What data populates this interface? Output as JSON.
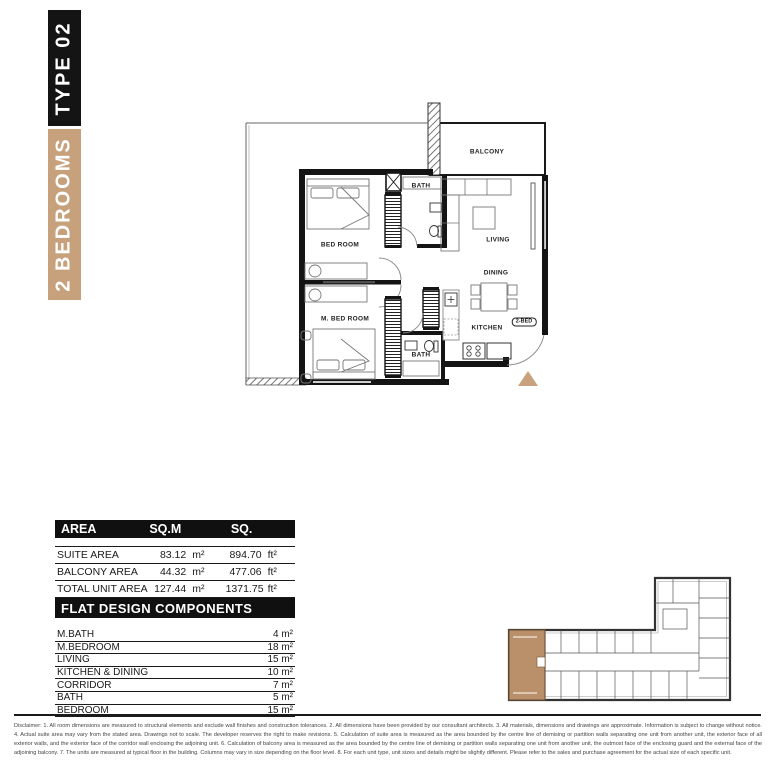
{
  "banner": {
    "type_label": "TYPE 02",
    "bedrooms_label": "2 BEDROOMS",
    "colors": {
      "type_bg": "#141414",
      "bedrooms_bg": "#c7a17c"
    }
  },
  "floor_plan": {
    "rooms": {
      "balcony": "BALCONY",
      "bedroom": "BED ROOM",
      "bath_top": "BATH",
      "living": "LIVING",
      "dining": "DINING",
      "kitchen": "KITCHEN",
      "master_bedroom": "M. BED ROOM",
      "bath_bottom": "BATH"
    },
    "unit_tag": "2-BED",
    "entry_marker_color": "#c8a27d"
  },
  "area_table": {
    "headers": [
      "AREA",
      "SQ.M",
      "SQ."
    ],
    "rows": [
      {
        "label": "SUITE AREA",
        "sqm": "83.12",
        "sqm_unit": "m²",
        "sqft": "894.70",
        "sqft_unit": "ft²"
      },
      {
        "label": "BALCONY AREA",
        "sqm": "44.32",
        "sqm_unit": "m²",
        "sqft": "477.06",
        "sqft_unit": "ft²"
      },
      {
        "label": "TOTAL UNIT AREA",
        "sqm": "127.44",
        "sqm_unit": "m²",
        "sqft": "1371.75",
        "sqft_unit": "ft²"
      }
    ]
  },
  "components_table": {
    "title": "FLAT DESIGN COMPONENTS",
    "rows": [
      {
        "label": "M.BATH",
        "value": "4 m²"
      },
      {
        "label": "M.BEDROOM",
        "value": "18 m²"
      },
      {
        "label": "LIVING",
        "value": "15 m²"
      },
      {
        "label": "KITCHEN & DINING",
        "value": "10 m²"
      },
      {
        "label": "CORRIDOR",
        "value": "7 m²"
      },
      {
        "label": "BATH",
        "value": "5 m²"
      },
      {
        "label": "BEDROOM",
        "value": "15 m²"
      }
    ]
  },
  "key_plan": {
    "highlight_color": "#b9906a"
  },
  "disclaimer": "Disclaimer: 1. All room dimensions are measured to structural elements and exclude wall finishes and construction tolerances. 2. All dimensions have been provided by our consultant architects. 3. All materials, dimensions and drawings are approximate. Information is subject to change without notice. 4. Actual suite area may vary from the stated area. Drawings not to scale. The developer reserves the right to make revisions. 5. Calculation of suite area is measured as the area bounded by the centre line of demising or partition walls separating one unit from another unit, the exterior face of all exterior walls, and the exterior face of the corridor wall enclosing the adjoining unit. 6. Calculation of balcony area is measured as the area bounded by the centre line of demising or partition walls separating one unit from another unit, the outmost face of the enclosing guard and the external face of the adjoining balcony. 7. The units are measured at typical floor in the building. Columns may vary in size depending on the floor level. 8. For each unit type, unit sizes and details might be slightly different. Please refer to the sales and purchase agreement for the actual size of each specific unit."
}
